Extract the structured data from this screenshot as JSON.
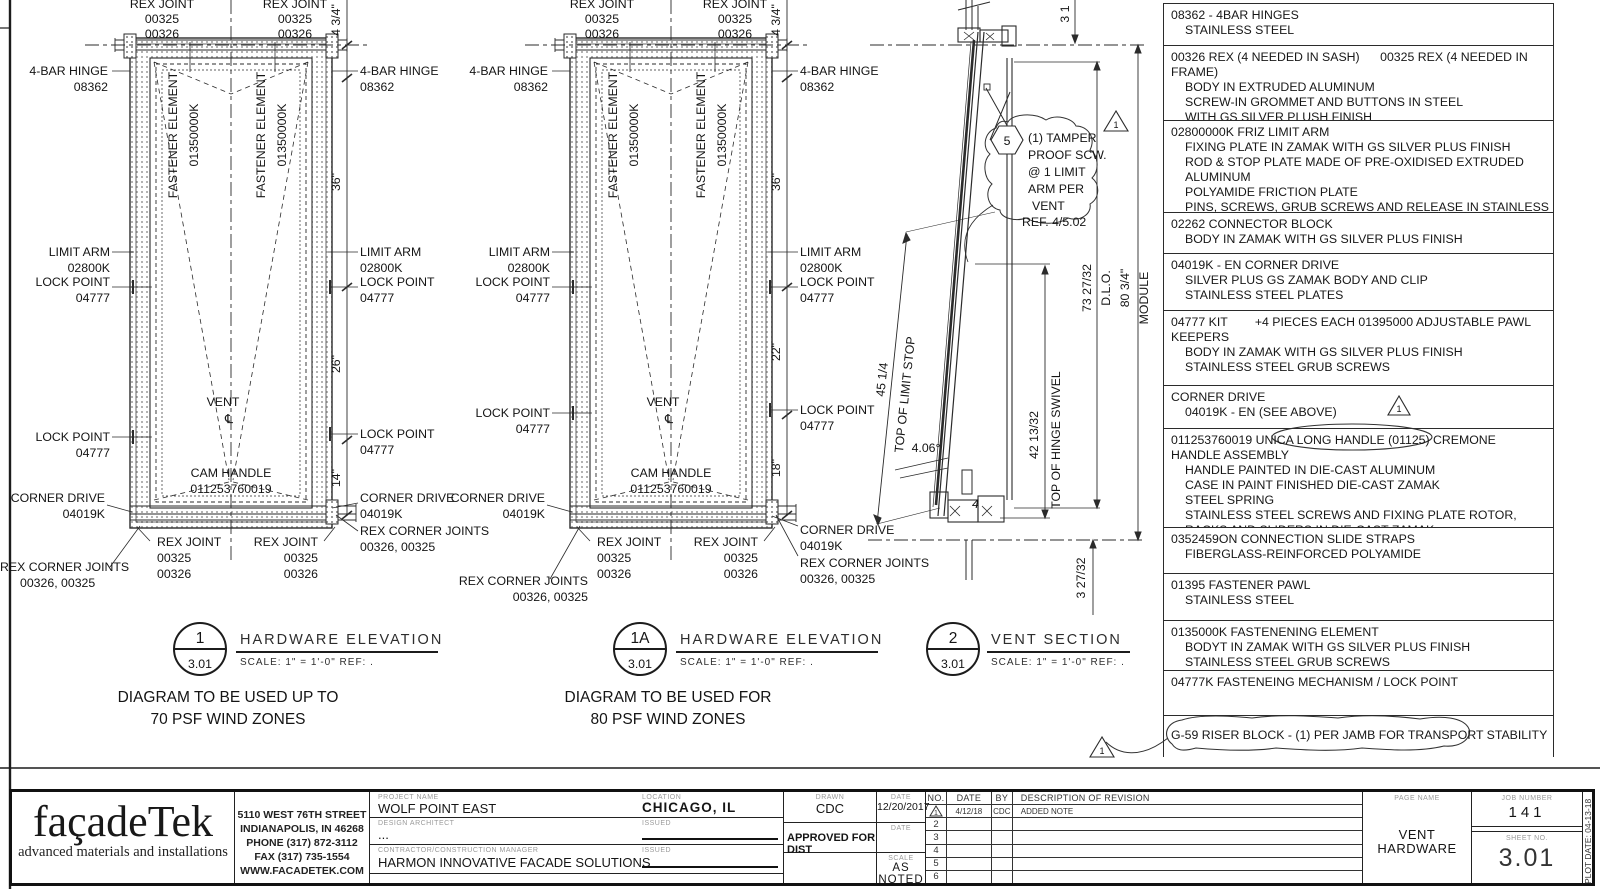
{
  "shared": {
    "rex_joint": "REX JOINT",
    "c325": "00325",
    "c326": "00326",
    "hinge": "4-BAR HINGE",
    "hinge_code": "08362",
    "fastener": "FASTENER ELEMENT",
    "fastener_code": "01350000K",
    "limit_arm": "LIMIT ARM",
    "limit_arm_code": "02800K",
    "lock": "LOCK POINT",
    "lock_code": "04777",
    "corner": "CORNER DRIVE",
    "corner_code": "04019K",
    "rex_corner": "REX CORNER JOINTS",
    "rex_corner_codes": "00326, 00325",
    "vent": "VENT",
    "cl": "℄",
    "cam": "CAM HANDLE",
    "cam_code": "011253760019",
    "dim_434": "4 3/4\"",
    "dim_36": "36\"",
    "elev_title": "HARDWARE ELEVATION",
    "scale_note": "SCALE:  1\" = 1'-0\"  REF: .",
    "sheet": "3.01"
  },
  "d1": {
    "num": "1",
    "dim2": "26\"",
    "dim3": "14\"",
    "note1": "DIAGRAM TO BE USED UP TO",
    "note2": "70 PSF WIND ZONES"
  },
  "d1a": {
    "num": "1A",
    "dim2": "22\"",
    "dim3": "18\"",
    "note1": "DIAGRAM TO BE USED FOR",
    "note2": "80 PSF WIND ZONES"
  },
  "d2": {
    "num": "2",
    "title": "VENT SECTION",
    "note_num": "5",
    "nl1": "(1) TAMPER",
    "nl2": "PROOF SCW.",
    "nl3": "@ 1 LIMIT",
    "nl4": "ARM PER",
    "nl5": "VENT",
    "nl6": "REF. 4/5.02",
    "tri": "1",
    "dim_top": "3 1",
    "dim_a": "45 1/4",
    "lbl_a": "TOP OF LIMIT STOP",
    "angle": "4.06°",
    "n4": "4",
    "dim_b": "42 13/32",
    "lbl_b": "TOP OF HINGE SWIVEL",
    "dim_c": "73 27/32",
    "lbl_c": "D.L.O.",
    "dim_d": "80 3/4\"",
    "lbl_d": "MODULE",
    "dim_e": "3 27/32"
  },
  "parts": {
    "tri": "1",
    "rows": [
      {
        "lines": [
          "08362 - 4BAR HINGES",
          "STAINLESS STEEL"
        ]
      },
      {
        "lines": [
          "00326 REX (4 NEEDED IN SASH)      00325 REX (4 NEEDED IN FRAME)",
          "BODY IN EXTRUDED ALUMINUM",
          "SCREW-IN GROMMET AND BUTTONS IN STEEL",
          "WITH GS SILVER PLUSH FINISH"
        ]
      },
      {
        "lines": [
          "02800000K FRIZ LIMIT ARM",
          "FIXING PLATE IN ZAMAK WITH GS SILVER PLUS FINISH",
          "ROD & STOP PLATE MADE OF PRE-OXIDISED EXTRUDED ALUMINUM",
          "POLYAMIDE FRICTION PLATE",
          "PINS, SCREWS, GRUB SCREWS AND RELEASE IN STAINLESS STEEL"
        ]
      },
      {
        "lines": [
          "02262 CONNECTOR BLOCK",
          "BODY IN ZAMAK WITH GS SILVER PLUS FINISH"
        ]
      },
      {
        "lines": [
          "04019K - EN CORNER DRIVE",
          "SILVER PLUS GS ZAMAK BODY AND CLIP",
          "STAINLESS STEEL PLATES"
        ]
      },
      {
        "lines": [
          "04777 KIT        +4 PIECES EACH 01395000 ADJUSTABLE PAWL",
          "KEEPERS",
          "BODY IN ZAMAK WITH GS SILVER PLUS FINISH",
          "STAINLESS STEEL GRUB SCREWS"
        ]
      },
      {
        "lines": [
          "CORNER DRIVE",
          "04019K - EN (SEE ABOVE)"
        ]
      },
      {
        "lines": [
          "011253760019 UNICA LONG HANDLE (01125) CREMONE HANDLE ASSEMBLY",
          "HANDLE PAINTED IN DIE-CAST ALUMINUM",
          "CASE IN PAINT FINISHED DIE-CAST ZAMAK",
          "STEEL SPRING",
          "STAINLESS STEEL SCREWS AND FIXING PLATE ROTOR,",
          "RACKS AND SLIDERS IN DIE-CAST ZAMAK"
        ]
      },
      {
        "lines": [
          "0352459ON CONNECTION SLIDE STRAPS",
          "FIBERGLASS-REINFORCED POLYAMIDE"
        ]
      },
      {
        "lines": [
          "01395 FASTENER PAWL",
          "STAINLESS STEEL"
        ]
      },
      {
        "lines": [
          "0135000K FASTENENING ELEMENT",
          "BODYT IN ZAMAK WITH GS SILVER PLUS FINISH",
          "STAINLESS STEEL GRUB SCREWS"
        ]
      },
      {
        "lines": [
          "04777K FASTENEING MECHANISM / LOCK POINT"
        ]
      },
      {
        "lines": [
          "G-59 RISER BLOCK - (1) PER JAMB FOR TRANSPORT STABILITY"
        ]
      }
    ]
  },
  "tb": {
    "logo": "façadeTek",
    "tagline": "advanced materials and installations",
    "addr1": "5110 WEST 76TH STREET",
    "addr2": "INDIANAPOLIS, IN 46268",
    "addr3": "PHONE (317) 872-3112",
    "addr4": "FAX (317) 735-1554",
    "addr5": "WWW.FACADETEK.COM",
    "project_label": "PROJECT NAME",
    "project": "WOLF POINT EAST",
    "location_label": "LOCATION",
    "location": "CHICAGO, IL",
    "architect_label": "DESIGN ARCHITECT",
    "architect": "...",
    "issued_label": "ISSUED",
    "contractor_label": "CONTRACTOR/CONSTRUCTION MANAGER",
    "contractor": "HARMON INNOVATIVE FACADE SOLUTIONS",
    "drawn_label": "DRAWN",
    "drawn": "CDC",
    "date_label": "DATE",
    "date": "12/20/2017",
    "approved": "APPROVED FOR DIST",
    "scale_label": "SCALE",
    "scale": "AS NOTED",
    "rev_no": "NO.",
    "rev_date": "DATE",
    "rev_by": "BY",
    "rev_desc": "DESCRIPTION  OF  REVISION",
    "r1_no": "1",
    "r1_date": "4/12/18",
    "r1_by": "CDC",
    "r1_desc": "ADDED  NOTE",
    "r2": "2",
    "r3": "3",
    "r4": "4",
    "r5": "5",
    "r6": "6",
    "title_label": "PAGE NAME",
    "title1": "VENT",
    "title2": "HARDWARE",
    "job_label": "JOB NUMBER",
    "job": "141",
    "sheetno_label": "SHEET NO.",
    "sheetno": "3.01",
    "plot": "PLOT DATE: 04-13-18"
  }
}
